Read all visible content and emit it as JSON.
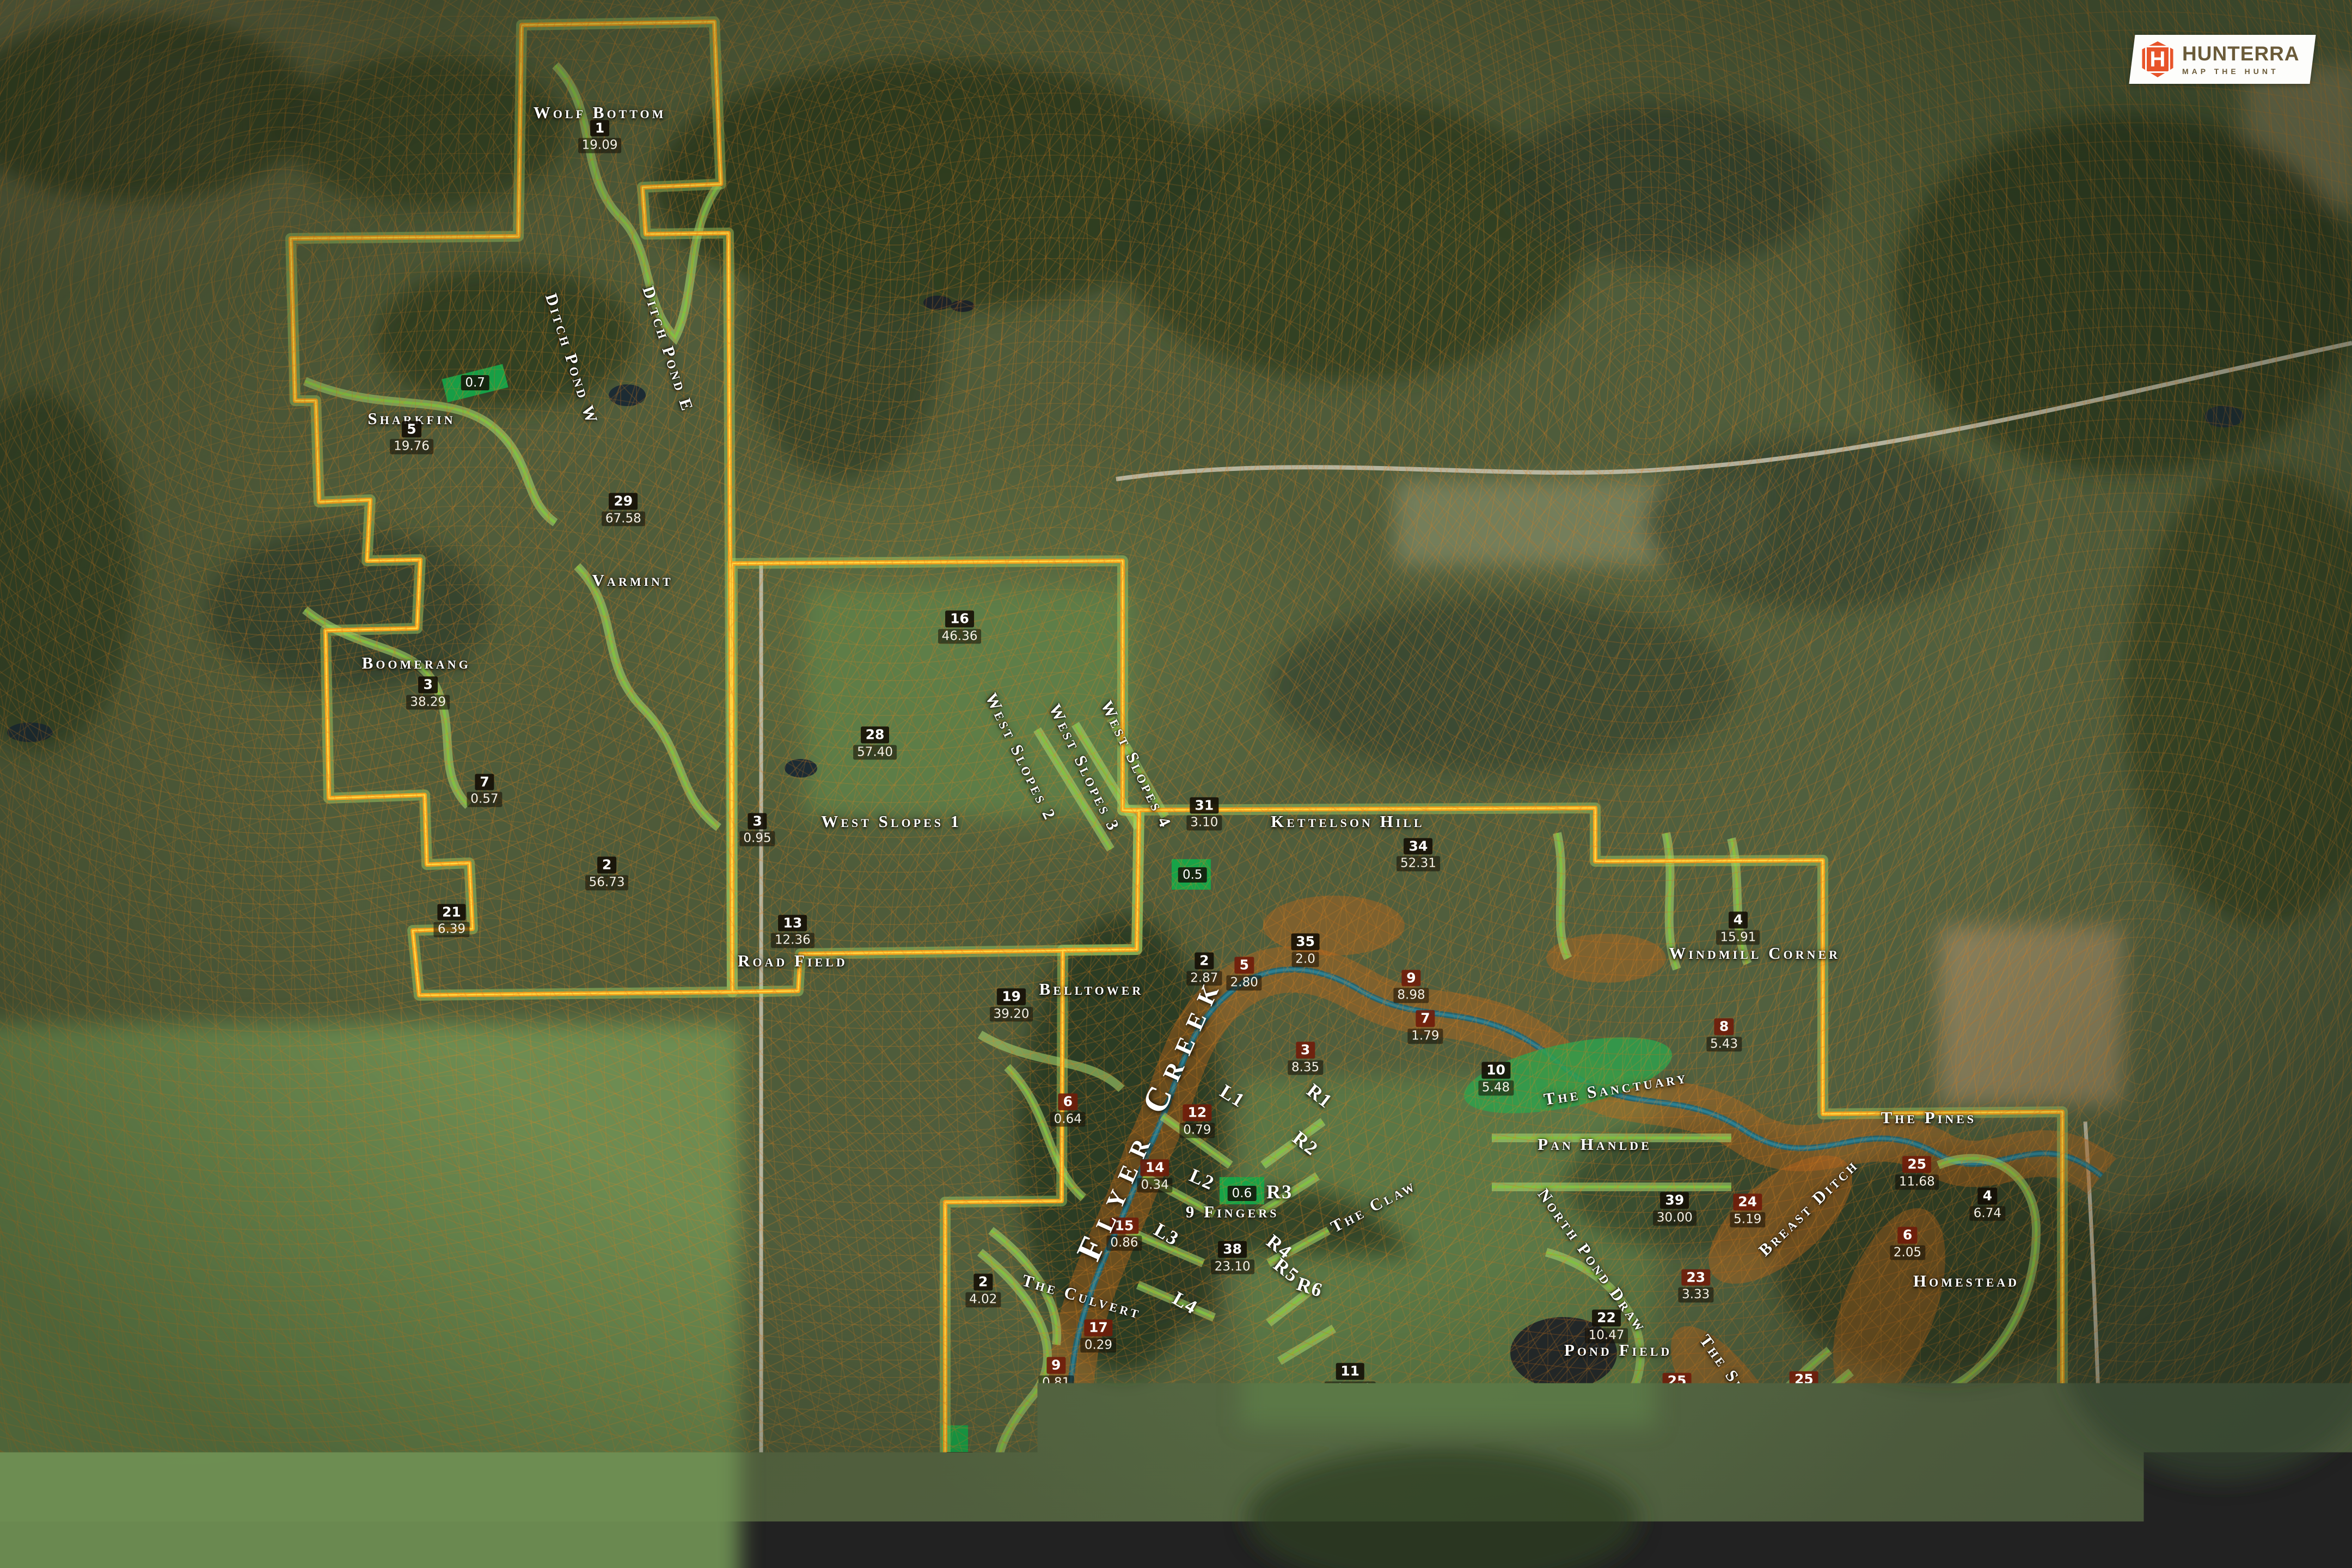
{
  "logo": {
    "brand": "HUNTERRA",
    "registered": "®",
    "tagline": "MAP THE HUNT",
    "accent": "#e8542a",
    "icon": "hexagon-h-shield"
  },
  "map": {
    "creek_label": {
      "text": "Flyer Creek",
      "x": 48.9,
      "y": 71.2,
      "rot": -66
    },
    "field_labels": [
      {
        "name": "Wolf Bottom",
        "x": 25.5,
        "y": 7.2,
        "rot": 0
      },
      {
        "name": "Sharkfin",
        "x": 17.5,
        "y": 26.7,
        "rot": 0
      },
      {
        "name": "Ditch Pond W",
        "x": 24.3,
        "y": 22.9,
        "rot": 72
      },
      {
        "name": "Ditch Pond E",
        "x": 28.4,
        "y": 22.3,
        "rot": 72
      },
      {
        "name": "Varmint",
        "x": 26.9,
        "y": 37.0,
        "rot": 0
      },
      {
        "name": "Boomerang",
        "x": 17.7,
        "y": 42.3,
        "rot": 0
      },
      {
        "name": "West Slopes 1",
        "x": 37.9,
        "y": 52.4,
        "rot": 0
      },
      {
        "name": "West Slopes 2",
        "x": 43.4,
        "y": 48.3,
        "rot": 64
      },
      {
        "name": "West Slopes 3",
        "x": 46.1,
        "y": 49.0,
        "rot": 64
      },
      {
        "name": "West Slopes 4",
        "x": 48.3,
        "y": 48.8,
        "rot": 64
      },
      {
        "name": "Road Field",
        "x": 33.7,
        "y": 61.3,
        "rot": 0
      },
      {
        "name": "Kettelson Hill",
        "x": 57.3,
        "y": 52.4,
        "rot": 0
      },
      {
        "name": "Belltower",
        "x": 46.4,
        "y": 63.1,
        "rot": 0
      },
      {
        "name": "9 Fingers",
        "x": 52.4,
        "y": 77.3,
        "rot": 0
      },
      {
        "name": "The Claw",
        "x": 58.4,
        "y": 76.9,
        "rot": -28
      },
      {
        "name": "The Culvert",
        "x": 46.0,
        "y": 82.7,
        "rot": 16
      },
      {
        "name": "Cedar Field",
        "x": 42.6,
        "y": 96.8,
        "rot": 0
      },
      {
        "name": "Pond Field",
        "x": 68.8,
        "y": 86.1,
        "rot": 0
      },
      {
        "name": "Pan Hanlde",
        "x": 67.8,
        "y": 73.0,
        "rot": 0
      },
      {
        "name": "The Sanctuary",
        "x": 68.7,
        "y": 69.4,
        "rot": -9
      },
      {
        "name": "Windmill Corner",
        "x": 74.6,
        "y": 60.8,
        "rot": 0
      },
      {
        "name": "The Pines",
        "x": 82.0,
        "y": 71.3,
        "rot": 0
      },
      {
        "name": "Homestead",
        "x": 83.6,
        "y": 81.7,
        "rot": 0
      },
      {
        "name": "The Spine",
        "x": 73.6,
        "y": 87.7,
        "rot": 54
      },
      {
        "name": "Breast Ditch",
        "x": 76.9,
        "y": 77.0,
        "rot": -44
      },
      {
        "name": "North Pond Draw",
        "x": 67.7,
        "y": 80.4,
        "rot": 54
      },
      {
        "name": "South Pond Draw",
        "x": 67.6,
        "y": 90.5,
        "rot": 10
      }
    ],
    "finger_labels": [
      {
        "name": "L1",
        "x": 52.4,
        "y": 69.9,
        "rot": 32
      },
      {
        "name": "L2",
        "x": 51.1,
        "y": 75.2,
        "rot": 24
      },
      {
        "name": "L3",
        "x": 49.6,
        "y": 78.7,
        "rot": 30
      },
      {
        "name": "L4",
        "x": 50.4,
        "y": 83.1,
        "rot": 30
      },
      {
        "name": "R1",
        "x": 56.1,
        "y": 69.9,
        "rot": 38
      },
      {
        "name": "R2",
        "x": 55.5,
        "y": 72.9,
        "rot": 38
      },
      {
        "name": "R3",
        "x": 54.4,
        "y": 76.0,
        "rot": 0
      },
      {
        "name": "R4",
        "x": 54.4,
        "y": 79.5,
        "rot": 38
      },
      {
        "name": "R5",
        "x": 54.7,
        "y": 81.0,
        "rot": 38
      },
      {
        "name": "R6",
        "x": 55.7,
        "y": 82.1,
        "rot": 18
      }
    ],
    "markers": [
      {
        "num": "1",
        "acres": "19.09",
        "x": 25.5,
        "y": 8.7,
        "type": "field"
      },
      {
        "num": "5",
        "acres": "19.76",
        "x": 17.5,
        "y": 27.9,
        "type": "field"
      },
      {
        "num": "29",
        "acres": "67.58",
        "x": 26.5,
        "y": 32.5,
        "type": "field"
      },
      {
        "num": "3",
        "acres": "38.29",
        "x": 18.2,
        "y": 44.2,
        "type": "field"
      },
      {
        "num": "7",
        "acres": "0.57",
        "x": 20.6,
        "y": 50.4,
        "type": "field"
      },
      {
        "num": "2",
        "acres": "56.73",
        "x": 25.8,
        "y": 55.7,
        "type": "field"
      },
      {
        "num": "21",
        "acres": "6.39",
        "x": 19.2,
        "y": 58.7,
        "type": "field"
      },
      {
        "num": "16",
        "acres": "46.36",
        "x": 40.8,
        "y": 40.0,
        "type": "field"
      },
      {
        "num": "28",
        "acres": "57.40",
        "x": 37.2,
        "y": 47.4,
        "type": "field"
      },
      {
        "num": "3",
        "acres": "0.95",
        "x": 32.2,
        "y": 52.9,
        "type": "field"
      },
      {
        "num": "13",
        "acres": "12.36",
        "x": 33.7,
        "y": 59.4,
        "type": "field"
      },
      {
        "num": "31",
        "acres": "3.10",
        "x": 51.2,
        "y": 51.9,
        "type": "field"
      },
      {
        "num": "34",
        "acres": "52.31",
        "x": 60.3,
        "y": 54.5,
        "type": "field"
      },
      {
        "num": "35",
        "acres": "2.0",
        "x": 55.5,
        "y": 60.6,
        "type": "field"
      },
      {
        "num": "2",
        "acres": "2.87",
        "x": 51.2,
        "y": 61.8,
        "type": "field"
      },
      {
        "num": "5",
        "acres": "2.80",
        "x": 52.9,
        "y": 62.1,
        "type": "timber"
      },
      {
        "num": "9",
        "acres": "8.98",
        "x": 60.0,
        "y": 62.9,
        "type": "timber"
      },
      {
        "num": "19",
        "acres": "39.20",
        "x": 43.0,
        "y": 64.1,
        "type": "field"
      },
      {
        "num": "3",
        "acres": "8.35",
        "x": 55.5,
        "y": 67.5,
        "type": "timber"
      },
      {
        "num": "6",
        "acres": "0.64",
        "x": 45.4,
        "y": 70.8,
        "type": "timber"
      },
      {
        "num": "12",
        "acres": "0.79",
        "x": 50.9,
        "y": 71.5,
        "type": "timber"
      },
      {
        "num": "14",
        "acres": "0.34",
        "x": 49.1,
        "y": 75.0,
        "type": "timber"
      },
      {
        "num": "15",
        "acres": "0.86",
        "x": 47.8,
        "y": 78.7,
        "type": "timber"
      },
      {
        "num": "38",
        "acres": "23.10",
        "x": 52.4,
        "y": 80.2,
        "type": "field"
      },
      {
        "num": "2",
        "acres": "4.02",
        "x": 41.8,
        "y": 82.3,
        "type": "field"
      },
      {
        "num": "17",
        "acres": "0.29",
        "x": 46.7,
        "y": 85.2,
        "type": "timber"
      },
      {
        "num": "9",
        "acres": "0.81",
        "x": 44.9,
        "y": 87.6,
        "type": "timber"
      },
      {
        "num": "18",
        "acres": "1.42",
        "x": 46.8,
        "y": 90.2,
        "type": "timber"
      },
      {
        "num": "10",
        "acres": "1.75",
        "x": 45.8,
        "y": 93.1,
        "type": "timber"
      },
      {
        "num": "36",
        "acres": "18.70",
        "x": 42.7,
        "y": 94.9,
        "type": "field"
      },
      {
        "num": "16",
        "acres": "0.30",
        "x": 46.8,
        "y": 98.5,
        "type": "timber"
      },
      {
        "num": "11",
        "acres": "104.12",
        "x": 57.4,
        "y": 88.0,
        "type": "field"
      },
      {
        "num": "22",
        "acres": "10.47",
        "x": 68.3,
        "y": 84.6,
        "type": "field"
      },
      {
        "num": "39",
        "acres": "30.00",
        "x": 71.2,
        "y": 77.1,
        "type": "field"
      },
      {
        "num": "24",
        "acres": "5.19",
        "x": 74.3,
        "y": 77.2,
        "type": "timber"
      },
      {
        "num": "23",
        "acres": "3.33",
        "x": 72.1,
        "y": 82.0,
        "type": "timber"
      },
      {
        "num": "8",
        "acres": "5.43",
        "x": 73.3,
        "y": 66.0,
        "type": "timber"
      },
      {
        "num": "7",
        "acres": "1.79",
        "x": 60.6,
        "y": 65.5,
        "type": "timber"
      },
      {
        "num": "10",
        "acres": "5.48",
        "x": 63.6,
        "y": 68.8,
        "type": "field"
      },
      {
        "num": "4",
        "acres": "15.91",
        "x": 73.9,
        "y": 59.2,
        "type": "field"
      },
      {
        "num": "25",
        "acres": "11.68",
        "x": 81.5,
        "y": 74.8,
        "type": "timber"
      },
      {
        "num": "4",
        "acres": "6.74",
        "x": 84.5,
        "y": 76.8,
        "type": "field"
      },
      {
        "num": "6",
        "acres": "2.05",
        "x": 81.1,
        "y": 79.3,
        "type": "timber"
      },
      {
        "num": "25",
        "acres": null,
        "x": 71.3,
        "y": 88.1,
        "type": "timber"
      },
      {
        "num": "25",
        "acres": null,
        "x": 76.7,
        "y": 88.0,
        "type": "timber"
      },
      {
        "num": "40",
        "acres": "23.12",
        "x": 73.0,
        "y": 90.6,
        "type": "field"
      }
    ],
    "food_plots": [
      {
        "acres": "0.7",
        "x": 20.2,
        "y": 24.4
      },
      {
        "acres": "0.5",
        "x": 50.7,
        "y": 55.8
      },
      {
        "acres": "0.6",
        "x": 52.8,
        "y": 76.1
      },
      {
        "acres": "0.5",
        "x": 40.8,
        "y": 93.1
      },
      {
        "acres": "0.5",
        "x": 72.6,
        "y": 93.8
      }
    ],
    "disclaimer_lines": [
      "accuracy of this data. This map should not be used for any purpose",
      "requiring exacting measurement of distance or representation of",
      "direction. In no event will Hunterra Mapping LLC or its officers be",
      "liable for any losses, damages, or decisions that might arise from the",
      "use of this map. Reproduction of this map is strictly prohibited."
    ]
  },
  "colors": {
    "boundary": "#f6a21c",
    "boundary_inner": "#ffe24a",
    "trail": "#9fd96a",
    "creek": "#226b7a",
    "erosion": "#c2661a",
    "food_plot": "#17a348",
    "contour": "#e28420"
  }
}
